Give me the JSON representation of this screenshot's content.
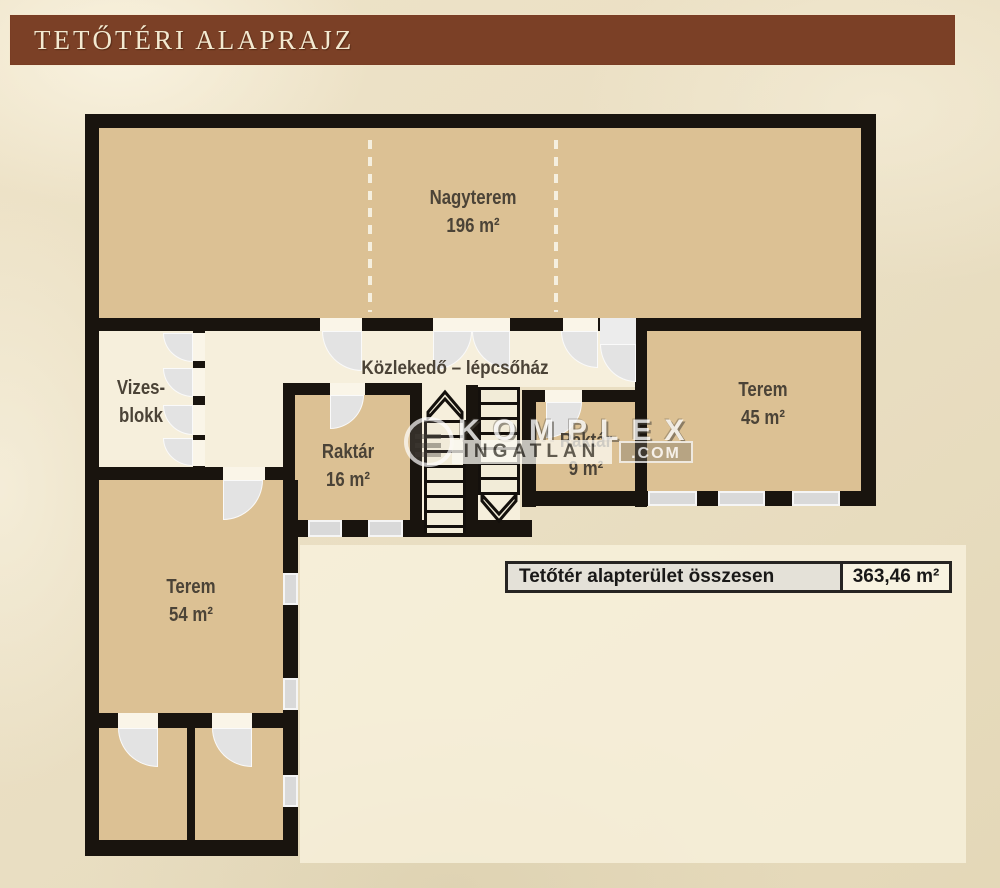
{
  "header": {
    "title": "TETŐTÉRI ALAPRAJZ"
  },
  "rooms": {
    "nagyterem": {
      "name": "Nagyterem",
      "area": "196 m²"
    },
    "vizesblokk": {
      "name_line1": "Vizes-",
      "name_line2": "blokk"
    },
    "kozlekedo": {
      "name": "Közlekedő – lépcsőház"
    },
    "raktar16": {
      "name": "Raktár",
      "area": "16 m²"
    },
    "raktar9": {
      "name": "Raktár",
      "area": "9 m²"
    },
    "terem45": {
      "name": "Terem",
      "area": "45 m²"
    },
    "terem54": {
      "name": "Terem",
      "area": "54 m²"
    }
  },
  "summary_table": {
    "label": "Tetőtér alapterület összesen",
    "value": "363,46 m²"
  },
  "watermark": {
    "brand": "KOMPLEX",
    "brand2": "INGATLAN",
    "tld": ".COM"
  },
  "colors": {
    "header_brown": "#7b4026",
    "paper_cream": "#e9dec2",
    "room_tan": "#dcc194",
    "room_cream": "#f6efdc",
    "wall_black": "#19140e",
    "door_gray": "#e3e3e3"
  }
}
